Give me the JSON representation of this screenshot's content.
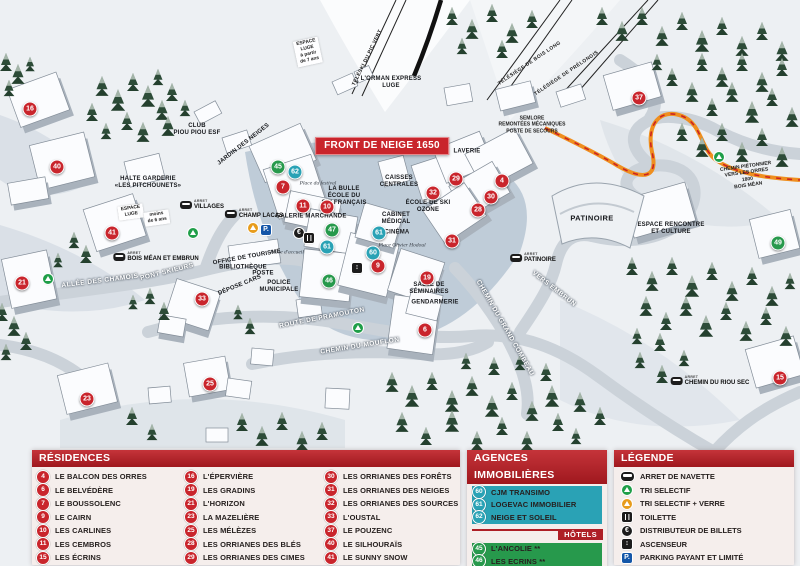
{
  "map": {
    "markers": [
      {
        "n": "16",
        "x": 30,
        "y": 109,
        "t": "r"
      },
      {
        "n": "40",
        "x": 57,
        "y": 167,
        "t": "r"
      },
      {
        "n": "41",
        "x": 112,
        "y": 233,
        "t": "r"
      },
      {
        "n": "21",
        "x": 22,
        "y": 283,
        "t": "r"
      },
      {
        "n": "33",
        "x": 202,
        "y": 299,
        "t": "r"
      },
      {
        "n": "23",
        "x": 87,
        "y": 399,
        "t": "r"
      },
      {
        "n": "25",
        "x": 210,
        "y": 384,
        "t": "r"
      },
      {
        "n": "45",
        "x": 278,
        "y": 167,
        "t": "h"
      },
      {
        "n": "62",
        "x": 295,
        "y": 172,
        "t": "a"
      },
      {
        "n": "7",
        "x": 283,
        "y": 187,
        "t": "r"
      },
      {
        "n": "11",
        "x": 303,
        "y": 206,
        "t": "r"
      },
      {
        "n": "10",
        "x": 327,
        "y": 207,
        "t": "r"
      },
      {
        "n": "47",
        "x": 332,
        "y": 230,
        "t": "h"
      },
      {
        "n": "61",
        "x": 327,
        "y": 247,
        "t": "a"
      },
      {
        "n": "61",
        "x": 379,
        "y": 233,
        "t": "a"
      },
      {
        "n": "60",
        "x": 373,
        "y": 253,
        "t": "a"
      },
      {
        "n": "9",
        "x": 378,
        "y": 266,
        "t": "r"
      },
      {
        "n": "46",
        "x": 329,
        "y": 281,
        "t": "h"
      },
      {
        "n": "19",
        "x": 427,
        "y": 278,
        "t": "r"
      },
      {
        "n": "6",
        "x": 425,
        "y": 330,
        "t": "r"
      },
      {
        "n": "32",
        "x": 433,
        "y": 193,
        "t": "r"
      },
      {
        "n": "29",
        "x": 456,
        "y": 179,
        "t": "r"
      },
      {
        "n": "4",
        "x": 502,
        "y": 181,
        "t": "r"
      },
      {
        "n": "30",
        "x": 491,
        "y": 197,
        "t": "r"
      },
      {
        "n": "28",
        "x": 478,
        "y": 210,
        "t": "r"
      },
      {
        "n": "31",
        "x": 452,
        "y": 241,
        "t": "r"
      },
      {
        "n": "37",
        "x": 639,
        "y": 98,
        "t": "r"
      },
      {
        "n": "49",
        "x": 778,
        "y": 243,
        "t": "h"
      },
      {
        "n": "15",
        "x": 780,
        "y": 378,
        "t": "r"
      }
    ],
    "labels": [
      {
        "text": "FRONT DE NEIGE 1650",
        "x": 382,
        "y": 146,
        "cls": "banner"
      },
      {
        "text": "TÉLÉSKI DU PIC VERT",
        "x": 368,
        "y": 58,
        "rot": -64,
        "cls": "lift"
      },
      {
        "text": "TÉLÉSIÈGE DE BOIS LONG",
        "x": 530,
        "y": 64,
        "rot": -34,
        "cls": "lift"
      },
      {
        "text": "TÉLÉSIÈGE DE PRÉLONGIS",
        "x": 567,
        "y": 74,
        "rot": -34,
        "cls": "lift"
      },
      {
        "text": "L'ORMAN EXPRESS\nLUGE",
        "x": 391,
        "y": 83,
        "cls": "poi-sm"
      },
      {
        "text": "SEMLORE\nREMONTÉES MÉCANIQUES\nPOSTE DE SECOURS",
        "x": 532,
        "y": 125,
        "cls": "path-label"
      },
      {
        "text": "ESPACE\nLUGE\nà partir\nde 7 ans",
        "x": 308,
        "y": 52,
        "rot": -12,
        "cls": "tag"
      },
      {
        "text": "ESPACE\nLUGE",
        "x": 131,
        "y": 212,
        "rot": -8,
        "cls": "tag"
      },
      {
        "text": "moins\nde 6 ans",
        "x": 157,
        "y": 218,
        "rot": -8,
        "cls": "tag"
      },
      {
        "text": "CLUB\nPIOU PIOU ESF",
        "x": 197,
        "y": 130,
        "cls": "poi-sm"
      },
      {
        "text": "JARDIN DES NEIGES",
        "x": 244,
        "y": 145,
        "rot": -38,
        "cls": "poi-sm"
      },
      {
        "text": "HALTE GARDERIE\n«LES PITCHOUNETS»",
        "x": 148,
        "y": 183,
        "cls": "poi-sm"
      },
      {
        "text": "LAVERIE",
        "x": 467,
        "y": 152,
        "cls": "poi-sm"
      },
      {
        "text": "CAISSES\nCENTRALES",
        "x": 399,
        "y": 182,
        "cls": "poi-sm"
      },
      {
        "text": "ÉCOLE DE SKI\nOZONE",
        "x": 428,
        "y": 207,
        "cls": "poi-sm"
      },
      {
        "text": "LA BULLE\nÉCOLE DU\nSKI FRANÇAIS",
        "x": 344,
        "y": 197,
        "cls": "poi-sm"
      },
      {
        "text": "Place du festival",
        "x": 318,
        "y": 184,
        "cls": "place"
      },
      {
        "text": "GALERIE MARCHANDE",
        "x": 311,
        "y": 217,
        "cls": "poi-sm"
      },
      {
        "text": "CABINET\nMÉDICAL",
        "x": 396,
        "y": 219,
        "cls": "poi-sm"
      },
      {
        "text": "CINÉMA",
        "x": 397,
        "y": 233,
        "cls": "poi-sm"
      },
      {
        "text": "Place Olivier Hodoul",
        "x": 402,
        "y": 246,
        "cls": "place"
      },
      {
        "text": "OFFICE DE TOURISME",
        "x": 247,
        "y": 258,
        "rot": -10,
        "cls": "poi-sm"
      },
      {
        "text": "BIBLIOTHÈQUE",
        "x": 243,
        "y": 268,
        "cls": "poi-sm"
      },
      {
        "text": "POSTE",
        "x": 263,
        "y": 274,
        "cls": "poi-sm"
      },
      {
        "text": "DÉPOSE CARS",
        "x": 240,
        "y": 286,
        "rot": -22,
        "cls": "poi-sm"
      },
      {
        "text": "POLICE\nMUNICIPALE",
        "x": 279,
        "y": 287,
        "cls": "poi-sm"
      },
      {
        "text": "Place d'accueil",
        "x": 287,
        "y": 253,
        "cls": "place"
      },
      {
        "text": "SALLE DE\nSÉMINAIRES",
        "x": 429,
        "y": 289,
        "cls": "poi-sm"
      },
      {
        "text": "GENDARMERIE",
        "x": 435,
        "y": 303,
        "cls": "poi-sm"
      },
      {
        "text": "PATINOIRE",
        "x": 592,
        "y": 218,
        "cls": "poi"
      },
      {
        "text": "ESPACE RENCONTRE\nET CULTURE",
        "x": 671,
        "y": 229,
        "cls": "poi-sm"
      },
      {
        "text": "CHEMIN PIÉTONNIER\nVERS LES ORRES 1800\nBOIS MÉAN",
        "x": 747,
        "y": 176,
        "rot": -8,
        "cls": "path-label"
      },
      {
        "text": "ALLÉE DES CHAMOIS",
        "x": 100,
        "y": 281,
        "rot": -7,
        "cls": "road"
      },
      {
        "text": "PONT SKIEURS",
        "x": 167,
        "y": 272,
        "rot": -14,
        "cls": "road"
      },
      {
        "text": "ROUTE DE PRAMOUTON",
        "x": 322,
        "y": 318,
        "rot": -11,
        "cls": "road"
      },
      {
        "text": "CHEMIN DU MOUFLON",
        "x": 360,
        "y": 346,
        "rot": -9,
        "cls": "road"
      },
      {
        "text": "CHEMIN DU GRAND COMBEAU",
        "x": 505,
        "y": 328,
        "rot": 60,
        "cls": "road"
      },
      {
        "text": "VERS EMBRUN",
        "x": 554,
        "y": 289,
        "rot": 38,
        "cls": "road"
      }
    ],
    "arrets": [
      {
        "name": "VILLAGES",
        "x": 202,
        "y": 205
      },
      {
        "name": "CHAMP LACAS",
        "x": 254,
        "y": 214
      },
      {
        "name": "BOIS MÉAN ET EMBRUN",
        "x": 156,
        "y": 257
      },
      {
        "name": "PATINOIRE",
        "x": 533,
        "y": 258
      },
      {
        "name": "CHEMIN DU RIOU SEC",
        "x": 710,
        "y": 381
      }
    ],
    "icons": [
      {
        "cls": "i-rec-g",
        "x": 193,
        "y": 233
      },
      {
        "cls": "i-rec-g",
        "x": 48,
        "y": 279
      },
      {
        "cls": "i-rec-g",
        "x": 358,
        "y": 328
      },
      {
        "cls": "i-rec-g",
        "x": 719,
        "y": 157
      },
      {
        "cls": "i-rec-o",
        "x": 253,
        "y": 228
      },
      {
        "cls": "i-park",
        "x": 266,
        "y": 230
      },
      {
        "cls": "i-euro",
        "x": 299,
        "y": 233
      },
      {
        "cls": "i-wc",
        "x": 309,
        "y": 238
      },
      {
        "cls": "i-lift",
        "x": 357,
        "y": 268
      }
    ]
  },
  "panels": {
    "residences": {
      "title": "RÉSIDENCES",
      "columns": [
        [
          {
            "n": "4",
            "name": "LE BALCON DES ORRES"
          },
          {
            "n": "6",
            "name": "LE BELVÉDÈRE"
          },
          {
            "n": "7",
            "name": "LE BOUSSOLENC"
          },
          {
            "n": "9",
            "name": "LE CAIRN"
          },
          {
            "n": "10",
            "name": "LES CARLINES"
          },
          {
            "n": "11",
            "name": "LES CEMBROS"
          },
          {
            "n": "15",
            "name": "LES ÉCRINS"
          }
        ],
        [
          {
            "n": "16",
            "name": "L'ÉPERVIÈRE"
          },
          {
            "n": "19",
            "name": "LES GRADINS"
          },
          {
            "n": "21",
            "name": "L'HORIZON"
          },
          {
            "n": "23",
            "name": "LA MAZELIÈRE"
          },
          {
            "n": "25",
            "name": "LES MÉLÈZES"
          },
          {
            "n": "28",
            "name": "LES ORRIANES DES BLÉS"
          },
          {
            "n": "29",
            "name": "LES ORRIANES DES CIMES"
          }
        ],
        [
          {
            "n": "30",
            "name": "LES ORRIANES DES FORÊTS"
          },
          {
            "n": "31",
            "name": "LES ORRIANES DES NEIGES"
          },
          {
            "n": "32",
            "name": "LES ORRIANES DES SOURCES"
          },
          {
            "n": "33",
            "name": "L'OUSTAL"
          },
          {
            "n": "37",
            "name": "LE POUZENC"
          },
          {
            "n": "40",
            "name": "LE SILHOURAÏS"
          },
          {
            "n": "41",
            "name": "LE SUNNY SNOW"
          }
        ]
      ]
    },
    "agences": {
      "title": "AGENCES IMMOBILIÈRES",
      "items": [
        {
          "n": "60",
          "name": "CJM TRANSIMO",
          "t": "a"
        },
        {
          "n": "61",
          "name": "LOGEVAC IMMOBILIER",
          "t": "a"
        },
        {
          "n": "62",
          "name": "NEIGE ET SOLEIL",
          "t": "a"
        }
      ]
    },
    "hotels": {
      "title": "HÔTELS",
      "items": [
        {
          "n": "45",
          "name": "L'ANCOLIE **",
          "t": "h"
        },
        {
          "n": "46",
          "name": "LES ECRINS **",
          "t": "h"
        },
        {
          "n": "47",
          "name": "L'ESCALE BLANCHE ***",
          "t": "h"
        },
        {
          "n": "49",
          "name": "LES TRAPPEURS **",
          "t": "h"
        }
      ]
    },
    "legende": {
      "title": "LÉGENDE",
      "items": [
        {
          "cls": "i-bus",
          "label": "ARRET DE NAVETTE",
          "icon": "bus-icon"
        },
        {
          "cls": "i-rec-g",
          "label": "TRI SELECTIF",
          "icon": "recycle-green-icon"
        },
        {
          "cls": "i-rec-o",
          "label": "TRI SELECTIF + VERRE",
          "icon": "recycle-yellow-icon"
        },
        {
          "cls": "i-wc",
          "label": "TOILETTE",
          "icon": "toilet-icon"
        },
        {
          "cls": "i-euro",
          "label": "DISTRIBUTEUR DE BILLETS",
          "icon": "euro-atm-icon"
        },
        {
          "cls": "i-lift",
          "label": "ASCENSEUR",
          "icon": "elevator-icon"
        },
        {
          "cls": "i-park",
          "label": "PARKING PAYANT ET LIMITÉ",
          "icon": "parking-icon"
        }
      ]
    }
  },
  "colors": {
    "residence_marker": "#c9252c",
    "agence_marker": "#2aa2b5",
    "hotel_marker": "#27994c",
    "header_red": "#ae1f26",
    "banner_red": "#c9252c"
  }
}
